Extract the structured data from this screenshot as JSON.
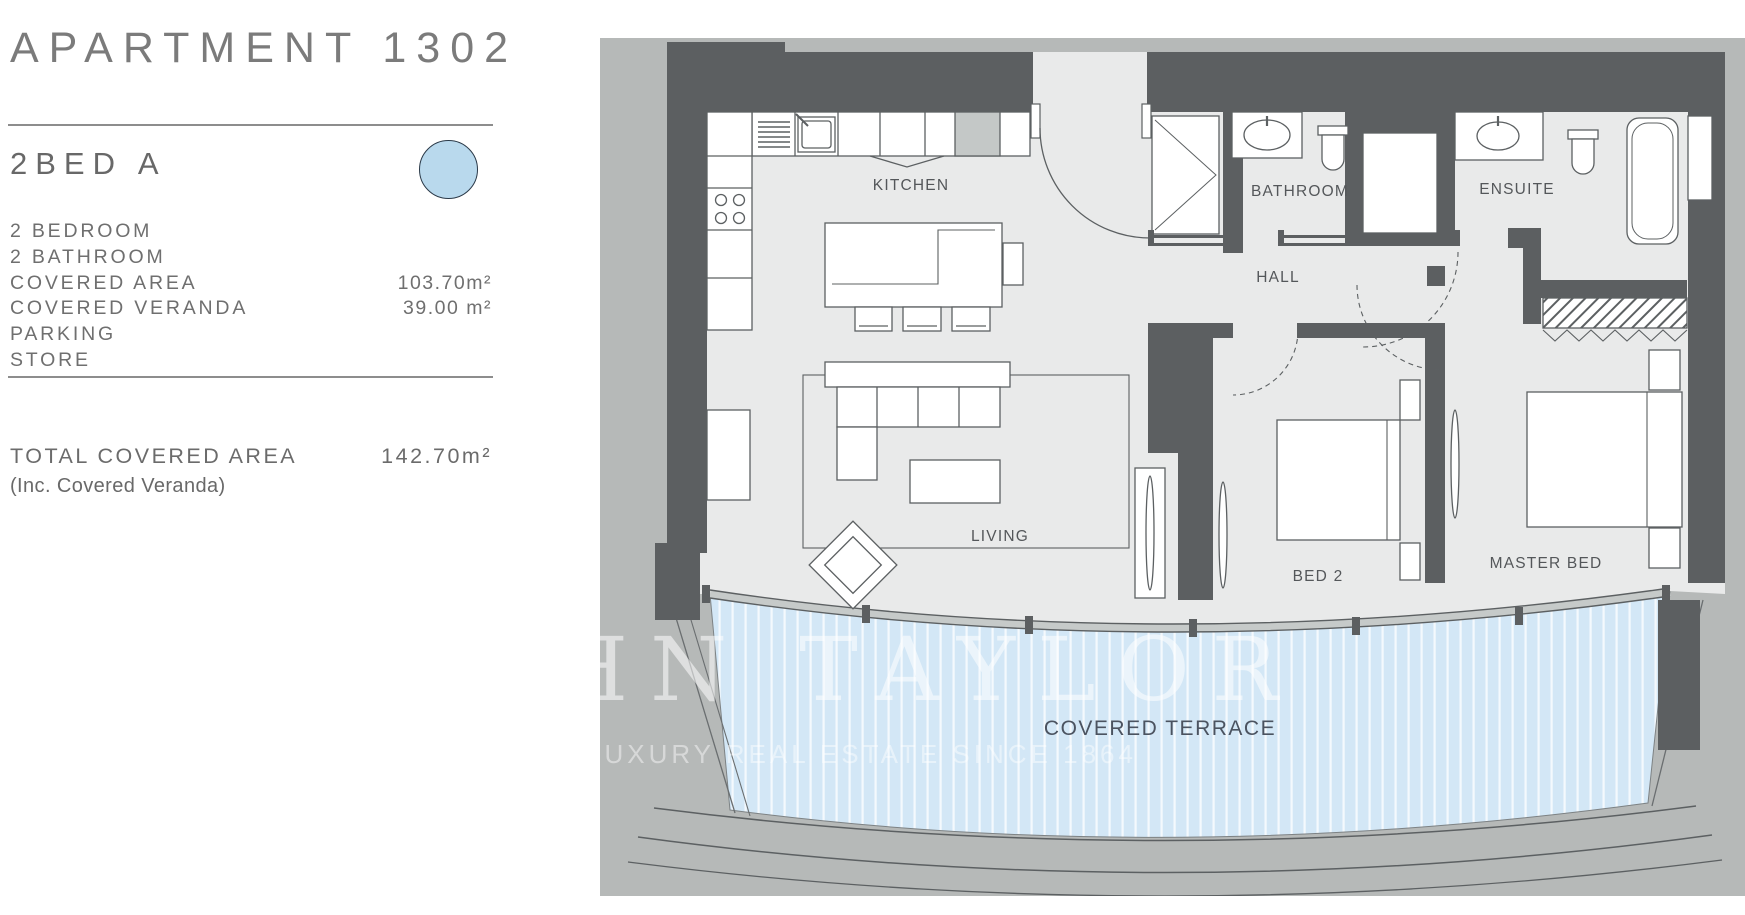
{
  "panel": {
    "title": "APARTMENT 1302",
    "unit_type": "2BED A",
    "legend_color": "#b9d9ed",
    "specs": [
      {
        "label": "2 BEDROOM",
        "value": ""
      },
      {
        "label": "2 BATHROOM",
        "value": ""
      },
      {
        "label": "COVERED AREA",
        "value": "103.70m²"
      },
      {
        "label": "COVERED VERANDA",
        "value": "39.00 m²"
      },
      {
        "label": "PARKING",
        "value": ""
      },
      {
        "label": "STORE",
        "value": ""
      }
    ],
    "total_label": "TOTAL COVERED AREA",
    "total_value": "142.70m²",
    "total_note": "(Inc. Covered Veranda)"
  },
  "plan": {
    "rooms": {
      "kitchen": "KITCHEN",
      "bathroom": "BATHROOM",
      "ensuite": "ENSUITE",
      "hall": "HALL",
      "living": "LIVING",
      "bed2": "BED 2",
      "master_bed": "MASTER BED",
      "terrace": "COVERED TERRACE"
    },
    "watermark": {
      "brand": "JOHN TAYLOR",
      "tagline": "LUXURY REAL ESTATE SINCE 1864"
    },
    "colors": {
      "wall": "#5c5f61",
      "floor": "#e9eaea",
      "exterior": "#b6b9b8",
      "terrace": "#d3e7f6",
      "fixture": "#ffffff"
    }
  }
}
